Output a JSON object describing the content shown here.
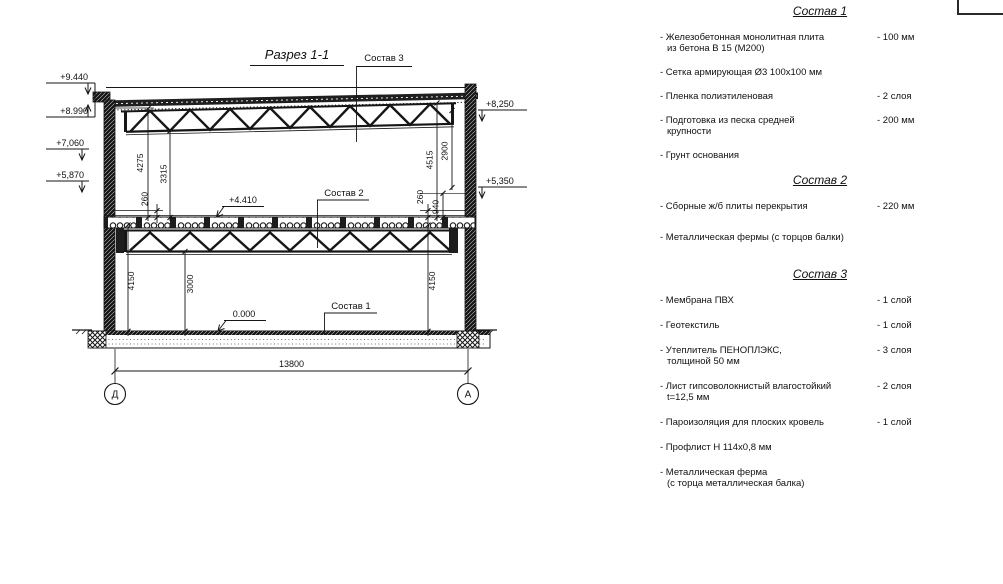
{
  "drawing": {
    "title": "Разрез 1-1",
    "callout_1": "Состав 1",
    "callout_2": "Состав 2",
    "callout_3": "Состав 3",
    "elev": {
      "e9440": "+9.440",
      "e8990": "+8.990",
      "e7060": "+7,060",
      "e5870": "+5,870",
      "e8250": "+8,250",
      "e5350": "+5,350",
      "e4410": "+4.410",
      "e0000": "0.000"
    },
    "dim": {
      "d4275": "4275",
      "d3315": "3315",
      "d260l": "260",
      "d4515": "4515",
      "d2900": "2900",
      "d260r": "260",
      "d940": "940",
      "d4150l": "4150",
      "d3000": "3000",
      "d4150r": "4150",
      "span": "13800"
    },
    "axis_left": "Д",
    "axis_right": "А"
  },
  "lists": [
    {
      "title": "Состав 1",
      "items": [
        {
          "line1": "- Железобетонная монолитная плита",
          "line2": "из бетона В 15 (М200)",
          "qty": "- 100 мм"
        },
        {
          "line1": "- Сетка армирующая Ø3 100х100 мм"
        },
        {
          "line1": "- Пленка полиэтиленовая",
          "qty": "- 2 слоя"
        },
        {
          "line1": "- Подготовка из песка средней",
          "line2": "крупности",
          "qty": "- 200 мм"
        },
        {
          "line1": "- Грунт основания"
        }
      ]
    },
    {
      "title": "Состав 2",
      "items": [
        {
          "line1": "- Сборные ж/б плиты перекрытия",
          "qty": "- 220 мм"
        },
        {
          "line1": "- Металлическая фермы (с торцов балки)"
        }
      ]
    },
    {
      "title": "Состав 3",
      "items": [
        {
          "line1": "- Мембрана ПВХ",
          "qty": "- 1 слой"
        },
        {
          "line1": "- Геотекстиль",
          "qty": "- 1 слой"
        },
        {
          "line1": "- Утеплитель ПЕНОПЛЭКС,",
          "line2": "толщиной 50 мм",
          "qty": "- 3 слоя"
        },
        {
          "line1": "- Лист гипсоволокнистый влагостойкий",
          "line2": "t=12,5 мм",
          "qty": "- 2 слоя"
        },
        {
          "line1": "- Пароизоляция для плоских кровель",
          "qty": "- 1 слой"
        },
        {
          "line1": "- Профлист Н 114х0,8 мм"
        },
        {
          "line1": "- Металлическая ферма",
          "line2": "(с торца металлическая балка)"
        }
      ]
    }
  ],
  "colors": {
    "ink": "#161616",
    "bg": "#ffffff"
  }
}
